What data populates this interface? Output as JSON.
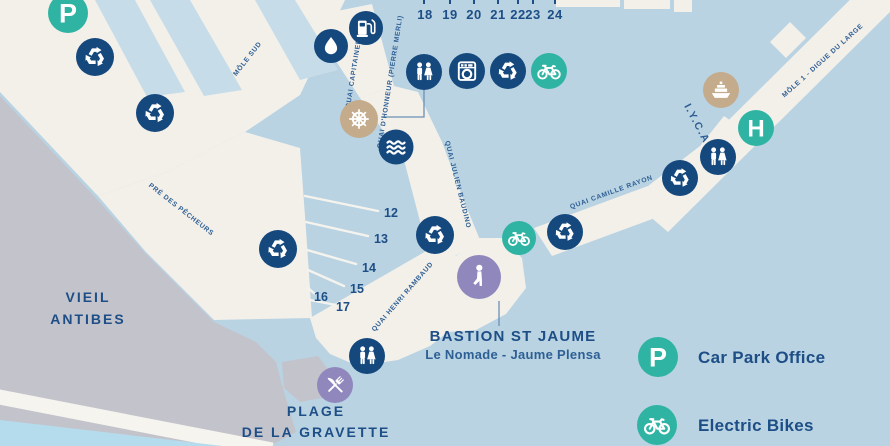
{
  "colors": {
    "water": "#b9d3e2",
    "basin_water": "#c7dce9",
    "land": "#f3f0ea",
    "old_town": "#c3c3cc",
    "navy_marker": "#15487d",
    "teal_marker": "#2fb3a2",
    "tan_marker": "#c3ab8b",
    "purple_marker": "#9088bd",
    "text_navy": "#1d4e86"
  },
  "areas": {
    "vieil_antibes": [
      "VIEIL",
      "ANTIBES"
    ],
    "pre_des_pecheurs": "PRÉ DES PÊCHEURS",
    "iyca": "I.Y.C.A",
    "plage": [
      "PLAGE",
      "DE LA GRAVETTE"
    ],
    "bastion_title": "BASTION ST JAUME",
    "bastion_subtitle": "Le Nomade - Jaume Plensa"
  },
  "quays": {
    "mole_sud": "MÔLE SUD",
    "capitainerie": "QUAI CAPITAINERIE",
    "honneur": "QUAI D'HONNEUR (PIERRE MERLI)",
    "julien_baudino": "QUAI JULIEN BAUDINO",
    "camille_rayon": "QUAI CAMILLE RAYON",
    "henri_rambaud": "QUAI HENRI RAMBAUD",
    "mole_1": "MÔLE 1 - DIGUE DU LARGE"
  },
  "pontoons_top": [
    "18",
    "19",
    "20",
    "21",
    "22",
    "23",
    "24"
  ],
  "pontoons_basin": [
    "12",
    "13",
    "14",
    "15",
    "16",
    "17"
  ],
  "markers": {
    "parking_letter": "P",
    "h_letter": "H"
  },
  "legend": [
    {
      "icon": "car-park-icon",
      "label": "Car Park Office"
    },
    {
      "icon": "electric-bike-icon",
      "label": "Electric Bikes"
    }
  ]
}
